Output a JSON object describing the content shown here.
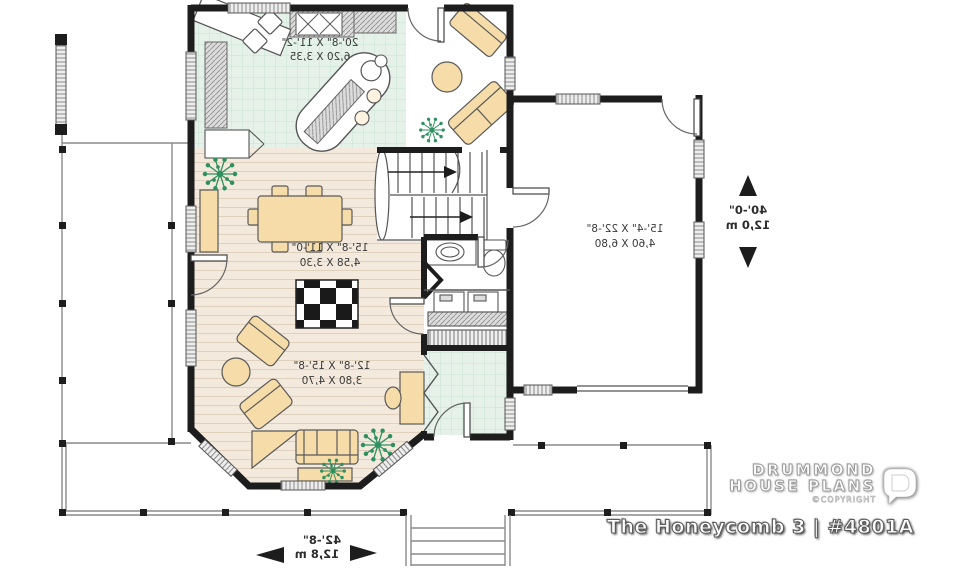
{
  "plan": {
    "rooms": {
      "kitchen": {
        "imperial": "20'-8\" X 11'-2\"",
        "metric": "6,20 X 3,35"
      },
      "dining": {
        "imperial": "15'-8\" X 11'-0\"",
        "metric": "4,58 X 3,30"
      },
      "living": {
        "imperial": "12'-8\" X 15'-8\"",
        "metric": "3,80 X 4,70"
      },
      "garage": {
        "imperial": "15'-4\" X 22'-8\"",
        "metric": "4,60 X 6,80"
      }
    },
    "dimensions": {
      "depth": {
        "imperial": "40'-0\"",
        "metric": "12,0 m"
      },
      "width": {
        "imperial": "42'-8\"",
        "metric": "12,8 m"
      }
    },
    "text_mirrored": true
  },
  "branding": {
    "name_line1": "DRUMMOND",
    "name_line2": "HOUSE PLANS",
    "copyright": "©COPYRIGHT",
    "plan_title": "The Honeycomb 3 | #4801A"
  },
  "colors": {
    "wall": "#1d1d1d",
    "tile_floor": "#e6f1ea",
    "tile_line": "#c6e2d1",
    "wood_floor": "#f3eadd",
    "wood_line": "#e0d1bf",
    "furniture": "#f6dca8",
    "counter": "#dcdcdc",
    "plant": "#2f9060",
    "label_text": "#3a3a3a"
  }
}
